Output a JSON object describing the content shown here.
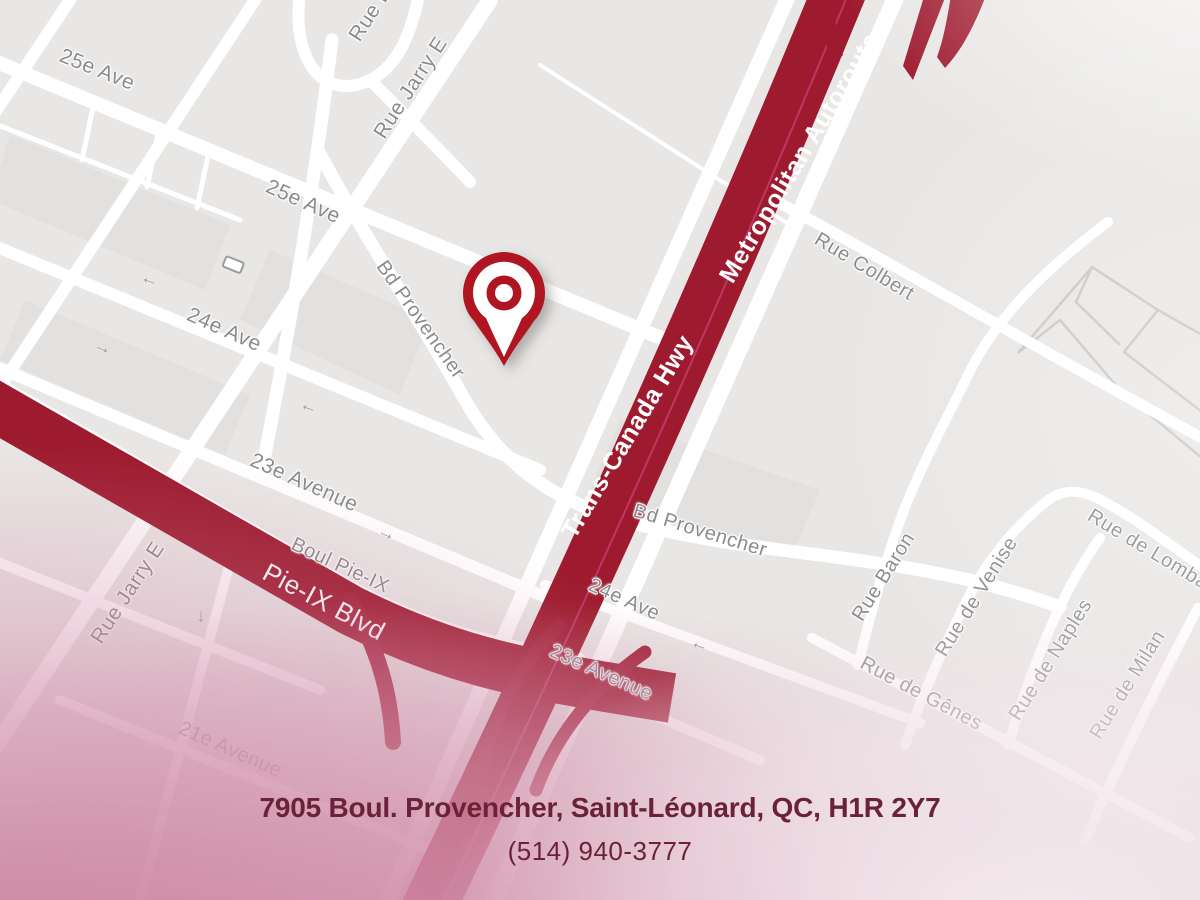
{
  "map": {
    "streets": {
      "ave25_a": "25e Ave",
      "ave25_b": "25e Ave",
      "jarry_a": "Rue Jarry E",
      "jarry_b": "Rue Jarry E",
      "rue_b_partial": "Rue B",
      "ave24_a": "24e Ave",
      "ave24_b": "24e Ave",
      "ave23_a": "23e Avenue",
      "ave23_b": "23e Avenue",
      "provencher_a": "Bd Provencher",
      "provencher_b": "Bd Provencher",
      "boul_pieix": "Boul Pie-IX",
      "pieix_blvd": "Pie-IX Blvd",
      "trans_canada": "Trans-Canada Hwy",
      "metropolitan": "Metropolitan Autoroute",
      "colbert": "Rue Colbert",
      "baron": "Rue Baron",
      "venise": "Rue de Venise",
      "naples": "Rue de Naples",
      "genes": "Rue de Gênes",
      "lombardie": "Rue de Lombardie",
      "milan": "Rue de Milan",
      "ave21": "21e Avenue"
    },
    "icons": {
      "arrow_left": "←",
      "arrow_right": "→",
      "arrow_down": "↓"
    }
  },
  "contact": {
    "address": "7905 Boul. Provencher, Saint-Léonard, QC, H1R 2Y7",
    "phone": "(514) 940-3777"
  },
  "colors": {
    "map_bg": "#e9e7e5",
    "road": "#ffffff",
    "block": "#e3e1df",
    "thin_line": "#c9c7c5",
    "hw": "#9e1b2f",
    "hw_lane": "#c13563",
    "ramp": "#a32038",
    "pin": "#b01223",
    "road_label": "#8b8b8b",
    "hw_label": "#ffffff",
    "addr": "#6b2239"
  }
}
